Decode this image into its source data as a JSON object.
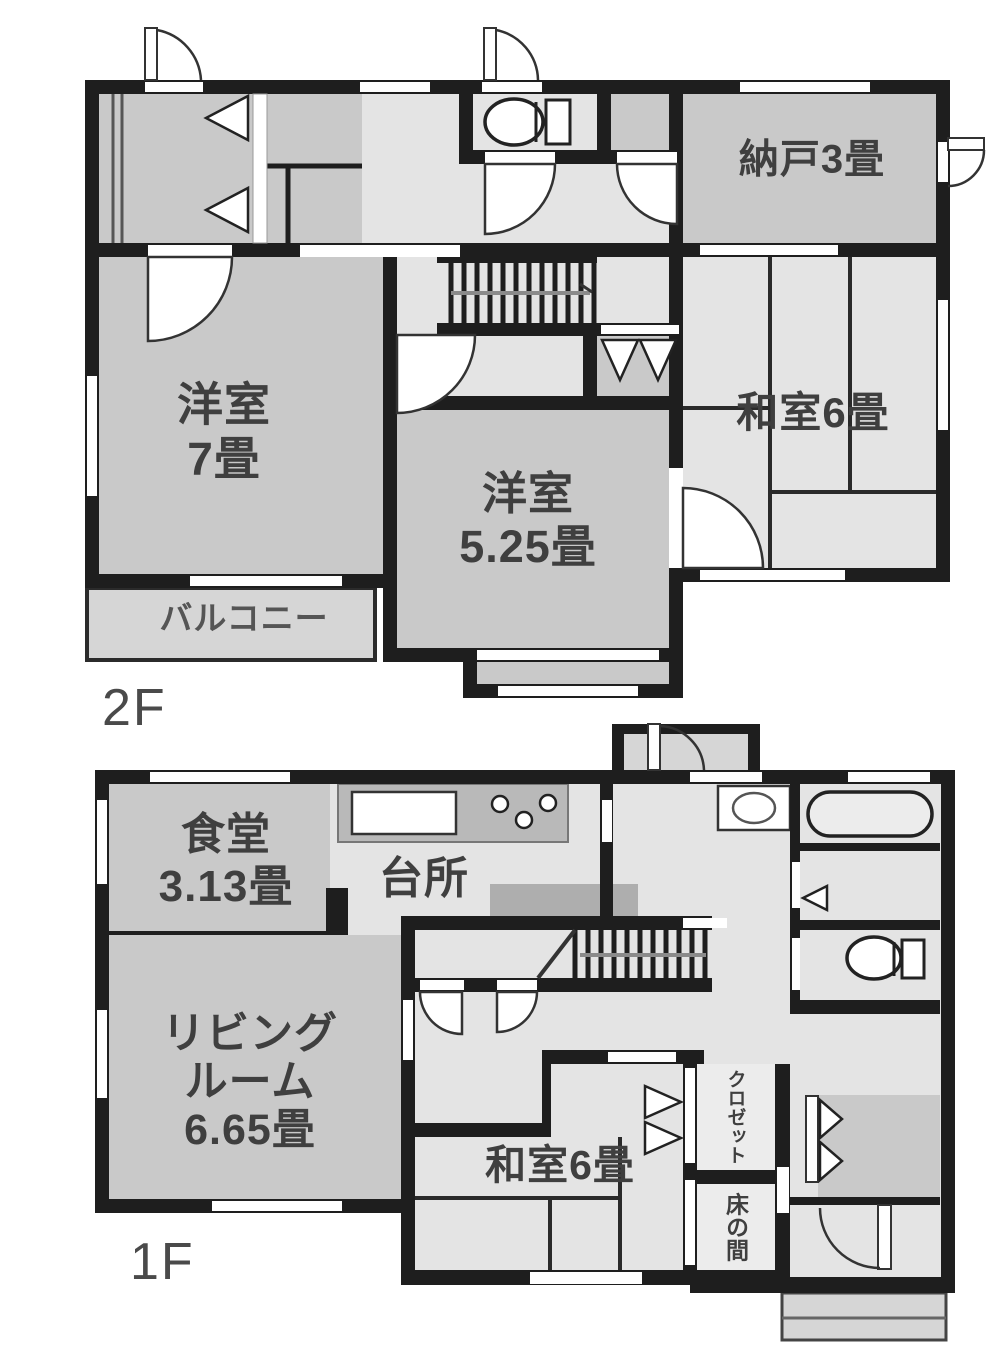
{
  "floor2": {
    "label": "2F",
    "rooms": {
      "nando": {
        "label": "納戸3畳"
      },
      "western7": {
        "line1": "洋室",
        "line2": "7畳"
      },
      "western525": {
        "line1": "洋室",
        "line2": "5.25畳"
      },
      "japanese6": {
        "label": "和室6畳"
      },
      "balcony": {
        "label": "バルコニー"
      }
    }
  },
  "floor1": {
    "label": "1F",
    "rooms": {
      "dining": {
        "line1": "食堂",
        "line2": "3.13畳"
      },
      "kitchen": {
        "label": "台所"
      },
      "living": {
        "line1": "リビング",
        "line2": "ルーム",
        "line3": "6.65畳"
      },
      "japanese6": {
        "label": "和室6畳"
      },
      "closet": {
        "label": "クロゼット"
      },
      "tokonoma": {
        "label": "床の間"
      }
    }
  },
  "legend": {
    "colors": {
      "wall": "#1e1e1e",
      "room_gray": "#c9c9c9",
      "room_light": "#e4e4e4",
      "balcony_gray": "#d6d6d6"
    }
  }
}
